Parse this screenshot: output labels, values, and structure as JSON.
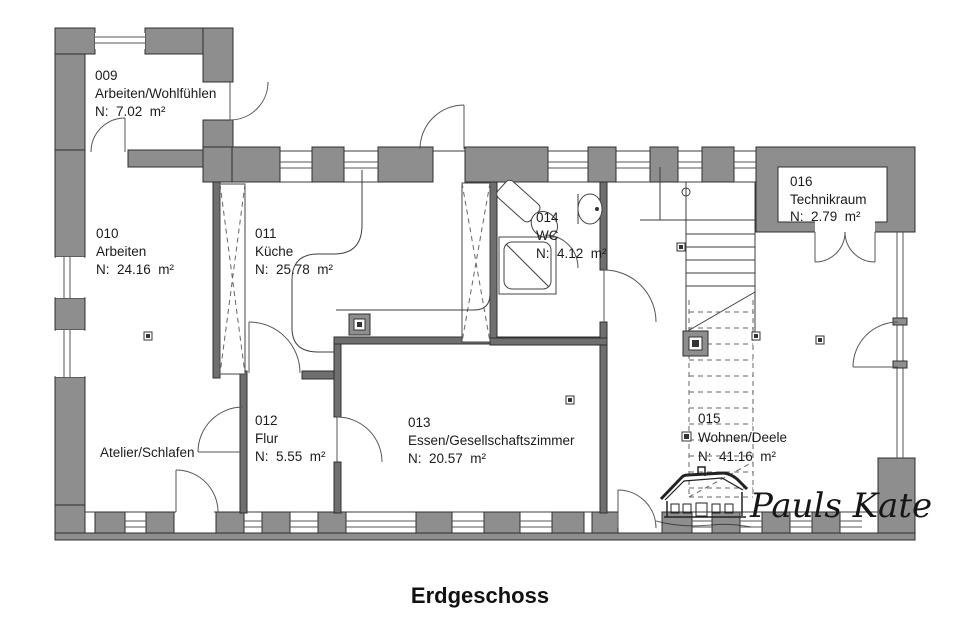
{
  "title": "Erdgeschoss",
  "logo": {
    "text": "Pauls Kate"
  },
  "rooms": [
    {
      "id": "009",
      "name": "Arbeiten/Wohlfühlen",
      "area": "N:  7.02  m²"
    },
    {
      "id": "010",
      "name": "Arbeiten",
      "area": "N:  24.16  m²"
    },
    {
      "id": "011",
      "name": "Küche",
      "area": "N:  25.78  m²"
    },
    {
      "id": "012",
      "name": "Flur",
      "area": "N:  5.55  m²"
    },
    {
      "id": "013",
      "name": "Essen/Gesellschaftszimmer",
      "area": "N:  20.57  m²"
    },
    {
      "id": "014",
      "name": "WC",
      "area": "N:  4.12  m²"
    },
    {
      "id": "015",
      "name": "Wohnen/Deele",
      "area": "N:  41.16  m²"
    },
    {
      "id": "016",
      "name": "Technikraum",
      "area": "N:  2.79  m²"
    }
  ],
  "annotations": {
    "atelier": "Atelier/Schlafen"
  },
  "colors": {
    "wall_fill": "#8e8e8e",
    "interior_wall": "#6f6f6f",
    "wall_stroke": "#2f2f2f",
    "line": "#555555",
    "text": "#1b1b1b",
    "background": "#ffffff"
  }
}
